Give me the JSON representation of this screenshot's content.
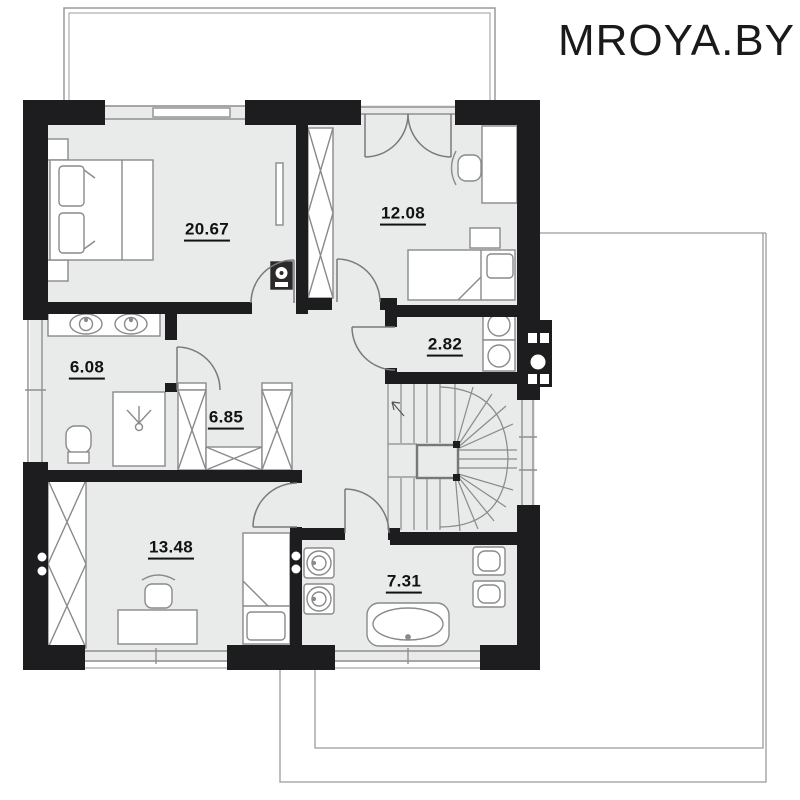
{
  "watermark": "MROYA.BY",
  "palette": {
    "background": "#ffffff",
    "wall": "#1d1d1f",
    "floor": "#e9eaea",
    "furniture_fill": "#ffffff",
    "furniture_outline": "#8a8a8a",
    "door_arc": "#7a7a7a",
    "thin_outline": "#9b9b9b",
    "label_text": "#121212",
    "appliance_dark": "#2a2a2a"
  },
  "rooms": [
    {
      "name": "bedroom-master",
      "area_label": "20.67"
    },
    {
      "name": "bedroom-upper-right",
      "area_label": "12.08"
    },
    {
      "name": "utility-laundry",
      "area_label": "2.82"
    },
    {
      "name": "bathroom-upper",
      "area_label": "6.08"
    },
    {
      "name": "hall-wardrobe",
      "area_label": "6.85"
    },
    {
      "name": "bedroom-lower",
      "area_label": "13.48"
    },
    {
      "name": "bathroom-lower",
      "area_label": "7.31"
    }
  ]
}
